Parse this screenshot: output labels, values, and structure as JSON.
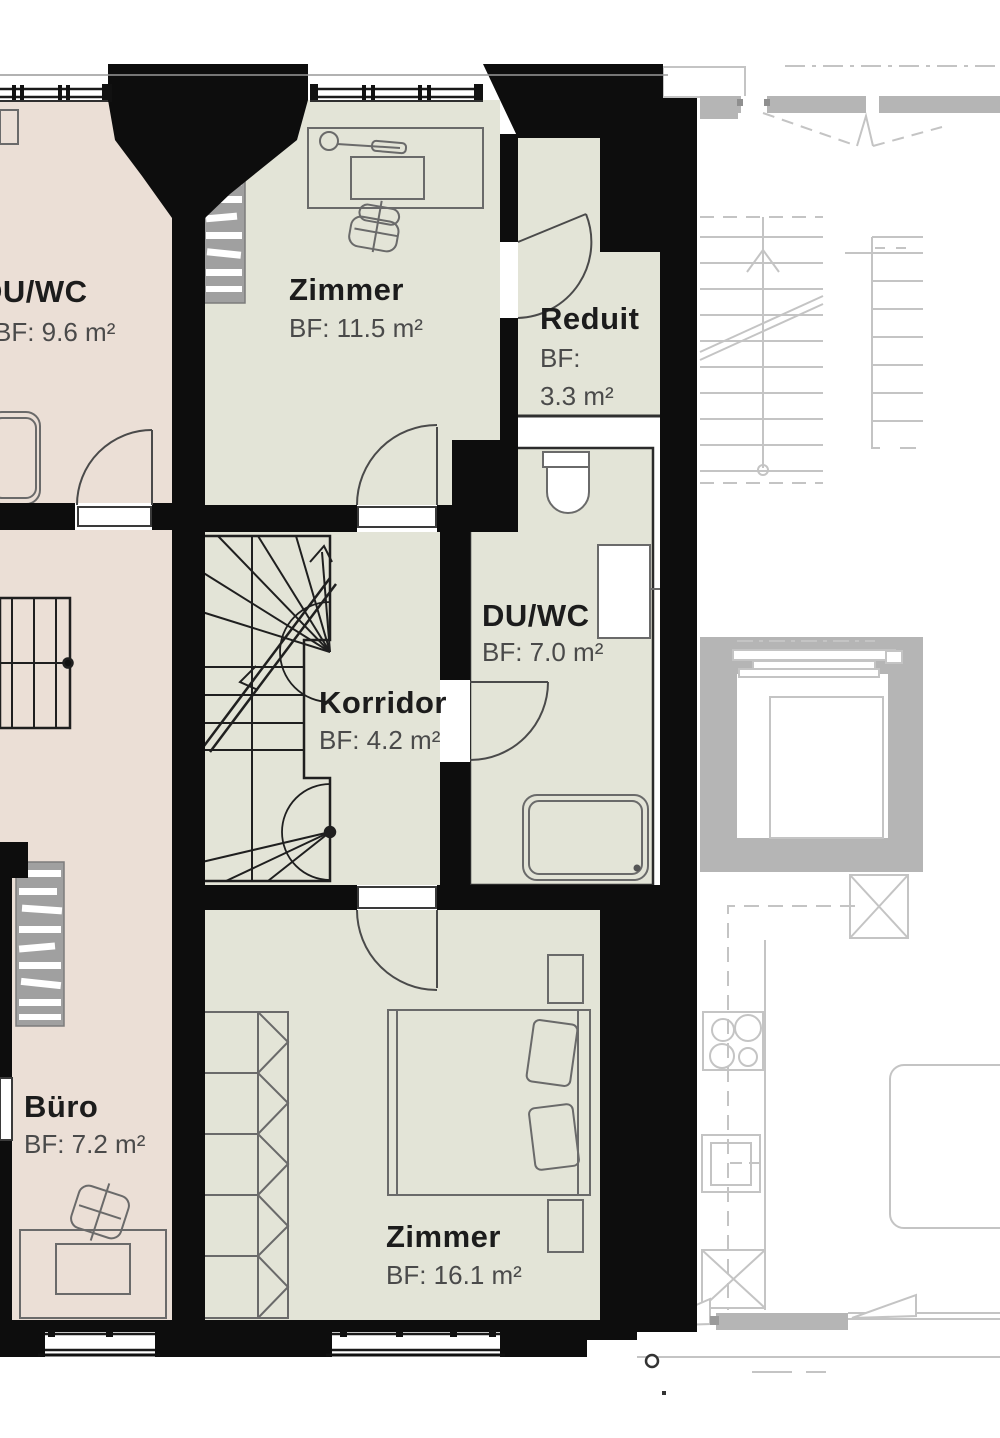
{
  "title": "Floor plan with room areas",
  "rooms": {
    "duwc_left": {
      "name": "DU/WC",
      "area": "BF: 9.6 m²"
    },
    "zimmer_top": {
      "name": "Zimmer",
      "area": "BF: 11.5 m²"
    },
    "reduit": {
      "name": "Reduit",
      "area_label": "BF:",
      "area_value": "3.3 m²"
    },
    "duwc_mid": {
      "name": "DU/WC",
      "area": "BF: 7.0 m²"
    },
    "korridor": {
      "name": "Korridor",
      "area": "BF: 4.2 m²"
    },
    "buero": {
      "name": "Büro",
      "area": "BF: 7.2 m²"
    },
    "zimmer_bottom": {
      "name": "Zimmer",
      "area": "BF: 16.1 m²"
    }
  },
  "colors": {
    "unit_left_fill": "#ebdfd6",
    "unit_mid_fill": "#e3e4d7",
    "wall_color": "#0d0d0d",
    "neighbor_gray": "#b5b5b5",
    "neighbor_line": "#c4c4c4",
    "furniture_line": "#6a6a6a",
    "label_dark": "#1c1c1c",
    "label_gray": "#4a4a4a"
  }
}
